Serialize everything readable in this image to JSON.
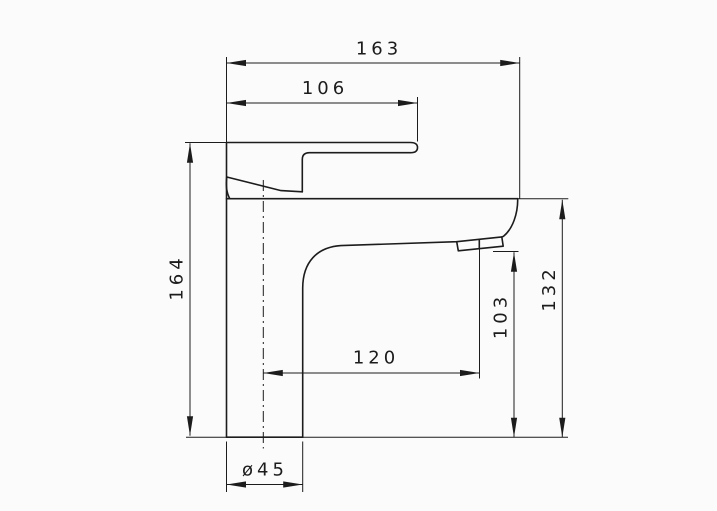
{
  "drawing": {
    "kind": "technical dimension drawing",
    "subject": "single-lever basin mixer faucet, side view",
    "colors": {
      "background": "#fbfbfb",
      "line": "#1c1c1c"
    },
    "dimension_labels": {
      "overall_width": "163",
      "lever_top_width": "106",
      "total_height": "164",
      "deck_to_top_height": "132",
      "aerator_clearance_height": "103",
      "spout_reach": "120",
      "base_diameter": "ø45"
    }
  }
}
